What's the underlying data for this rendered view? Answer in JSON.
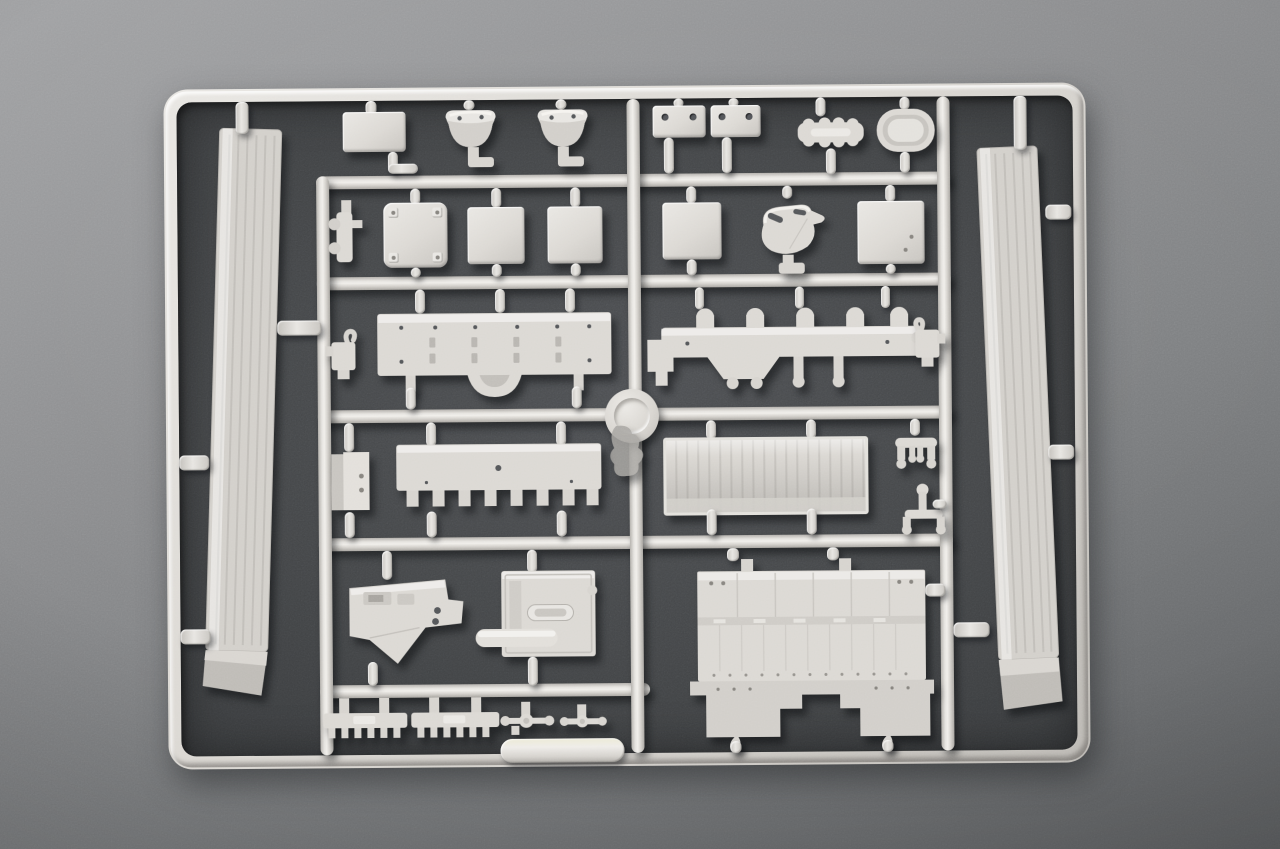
{
  "scene": {
    "type": "photograph",
    "subject": "Light grey injection-molded plastic model kit sprue (parts tree) lying on a grey textured surface, photographed from above",
    "sprue_badge": "embossed circular runner badge at the central rail crossing (marking illegible)",
    "plastic_color_name": "light grey styrene",
    "surface_color_name": "grey speckled board, darker in the shadowed area inside the frame"
  },
  "colors": {
    "plastic": "#dcd9d4",
    "plastic_highlight": "#f1efeb",
    "plastic_shadow": "#aaa7a2",
    "outer_bg_light": "#a2a3a5",
    "outer_bg": "#8b8c8e",
    "outer_bg_dark": "#5d5f61",
    "interior_bg": "#4b4d50",
    "interior_bg_dark": "#383a3c",
    "part_shadow": "rgba(5,7,10,0.5)"
  },
  "parts": [
    {
      "name": "left-ribbed-side-panel",
      "description": "long vertical ribbed panel with angled foot, left side"
    },
    {
      "name": "right-ribbed-side-panel",
      "description": "long vertical ribbed panel with angled foot, right side"
    },
    {
      "name": "rectangular-plate",
      "description": "small plain rectangular plate, top left"
    },
    {
      "name": "dome-cover-left",
      "description": "bowl/dome shaped cover with two holes"
    },
    {
      "name": "dome-cover-right",
      "description": "bowl/dome shaped cover with two holes"
    },
    {
      "name": "hinge-plate-a",
      "description": "small plate with two holes"
    },
    {
      "name": "hinge-plate-b",
      "description": "small plate with two holes"
    },
    {
      "name": "scalloped-block",
      "description": "small elongated block with scalloped edges"
    },
    {
      "name": "oval-hatch",
      "description": "oval hatch with recessed ring"
    },
    {
      "name": "side-bracket",
      "description": "narrow bracket with side knobs"
    },
    {
      "name": "access-panel",
      "description": "rounded square panel with corner pads"
    },
    {
      "name": "square-panel-a",
      "description": "plain square panel"
    },
    {
      "name": "square-panel-b",
      "description": "plain square panel"
    },
    {
      "name": "square-panel-c",
      "description": "plain square panel"
    },
    {
      "name": "square-panel-d",
      "description": "plain square panel"
    },
    {
      "name": "teapot-shaped-casting",
      "description": "rounded casting with spout and two slots"
    },
    {
      "name": "hull-floor-panel",
      "description": "long flat panel with rivet holes and round center bulge"
    },
    {
      "name": "suspension-beam",
      "description": "long beam with round-topped tabs and legs with round feet"
    },
    {
      "name": "hook-fitting-left",
      "description": "small fitting with curled hook"
    },
    {
      "name": "hook-fitting-right",
      "description": "small fitting with curled hook"
    },
    {
      "name": "runner-badge-disc",
      "description": "embossed circular sprue badge"
    },
    {
      "name": "flash-blob",
      "description": "irregular thin flash piece below badge"
    },
    {
      "name": "stowage-box",
      "description": "small rectangular box, two faces visible"
    },
    {
      "name": "toothed-rail",
      "description": "long rail with rectangular teeth along lower edge"
    },
    {
      "name": "ribbed-tailgate-panel",
      "description": "bordered panel with vertical ribs"
    },
    {
      "name": "four-foot-bracket",
      "description": "small bracket with four round feet"
    },
    {
      "name": "stand-fitting",
      "description": "small stand with round feet and stem"
    },
    {
      "name": "angled-glacis-plate",
      "description": "polygonal plate with angled lower edge, slots and two holes"
    },
    {
      "name": "equipment-tray",
      "description": "rectangular tray with pill-shaped recess and round-tipped bar"
    },
    {
      "name": "lower-hull-panel",
      "description": "large panel with panel seams, bolt dots and stepped skirt with two legs"
    },
    {
      "name": "track-comb-a",
      "description": "small comb-toothed strip"
    },
    {
      "name": "track-comb-b",
      "description": "small comb-toothed strip"
    },
    {
      "name": "axle-cluster-a",
      "description": "tiny rod with center disc and end knobs"
    },
    {
      "name": "axle-cluster-b",
      "description": "tiny rod with center disc and end knobs"
    },
    {
      "name": "bottom-grip-tab",
      "description": "wide flat tab on the bottom frame rail"
    }
  ]
}
